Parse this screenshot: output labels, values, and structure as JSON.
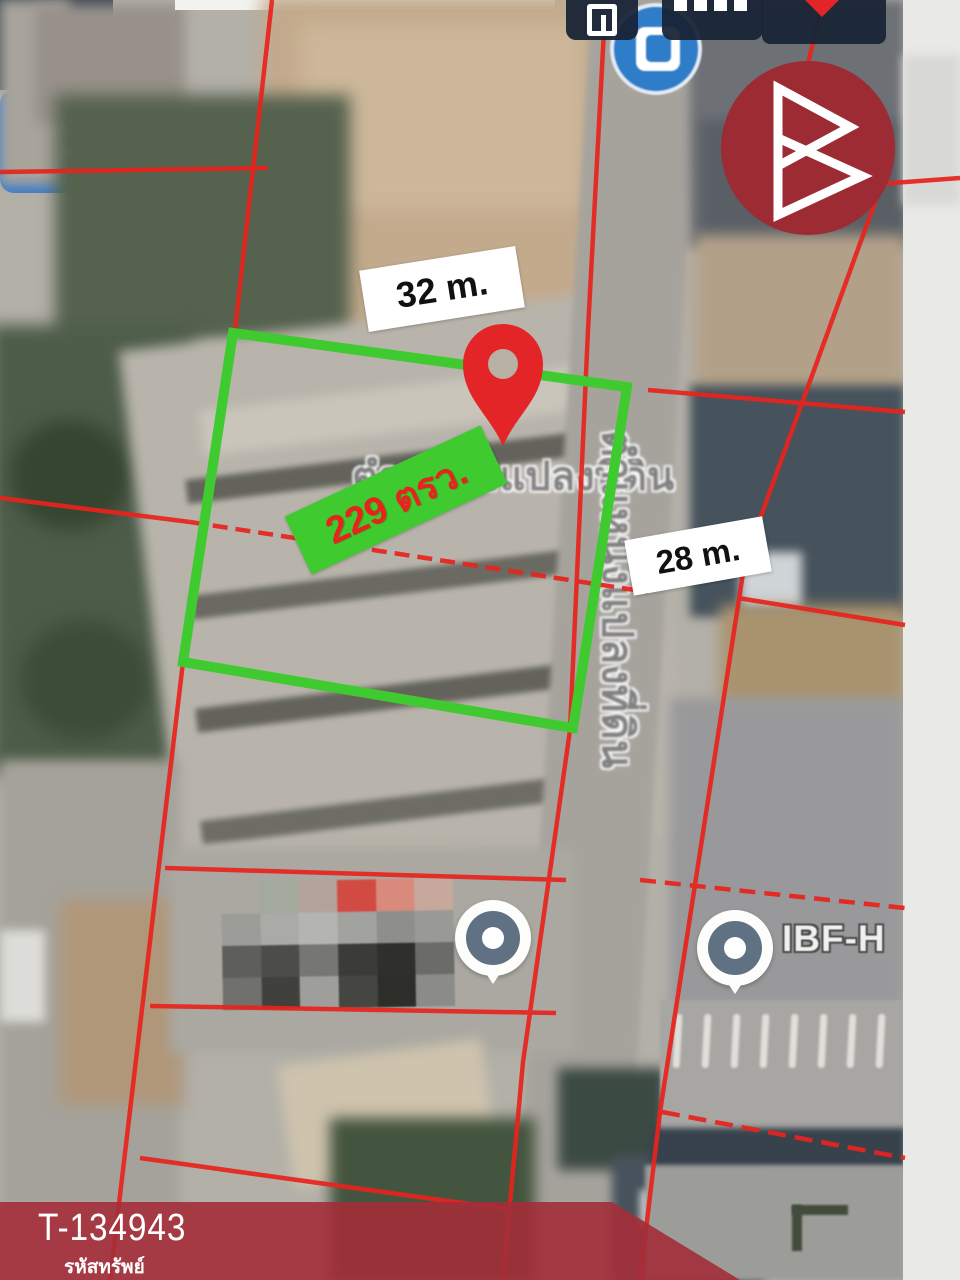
{
  "toolbar": {
    "close_glyph": "✕"
  },
  "map": {
    "watermark_text": "ตำแหน่งแปลงที่ดิน",
    "poi_label": "IBF-H",
    "measurements": {
      "top_edge": "32 m.",
      "right_edge": "28 m.",
      "area": "229 ตรว."
    }
  },
  "banner": {
    "code": "T-134943",
    "caption": "รหัสทรัพย์"
  },
  "colors": {
    "boundary_green": "#3fcb2f",
    "cadastral_red": "#e8231d",
    "pin_red": "#e42527",
    "banner_red": "#a32d39",
    "logo_red": "#9d2b33",
    "accent_blue": "#3d7cc9"
  },
  "censor_blocks": [
    [
      "#aaa89f",
      "#a3a99c",
      "#b3a29b",
      "#d14b43",
      "#d88a7c",
      "#c7a89c"
    ],
    [
      "#9c9c98",
      "#aaaaa6",
      "#b4b4b0",
      "#a2a29e",
      "#8e8e8a",
      "#999995"
    ],
    [
      "#5e5e5a",
      "#4c4c48",
      "#767672",
      "#3b3b37",
      "#2f2f2b",
      "#6b6b67"
    ],
    [
      "#70706c",
      "#40403c",
      "#9e9e9a",
      "#454541",
      "#2d2d29",
      "#8b8b87"
    ]
  ]
}
